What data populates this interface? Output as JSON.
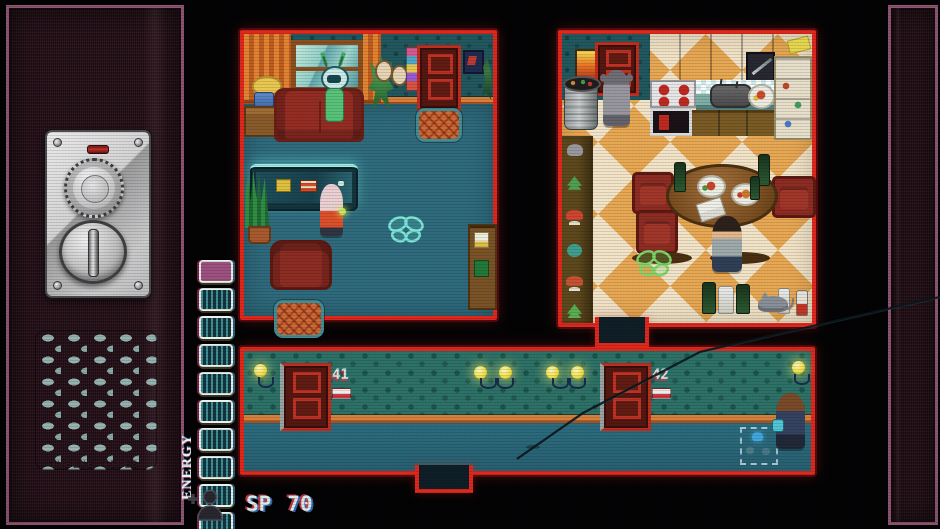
{
  "console": {
    "brand_label": "TWELVE TILES",
    "panel_color": "#281119",
    "trim_color": "#8d5472",
    "indicator_light_color": "#c23028",
    "controls": [
      "tuning-dial",
      "selector-knob"
    ]
  },
  "hud": {
    "energy_label": "ENERGY",
    "energy_segments_total": 10,
    "energy_segments_filled": 1,
    "energy_filled_color": "#9c517e",
    "energy_empty_stripe_color": "#3f8f96",
    "sp_label": "SP",
    "sp_value": "70",
    "follower_icon": "person-plus-icon"
  },
  "rooms": {
    "living_room": {
      "name": "living room",
      "objects": [
        "curtains",
        "window",
        "table-lamp",
        "side-table",
        "plant-vase",
        "couch",
        "alien-npc",
        "potted-plant",
        "wall-portraits",
        "wall-shelf",
        "door",
        "picture-frame",
        "door-mat",
        "tv-cabinet",
        "snake-plant",
        "girl-npc",
        "armchair",
        "floor-rug",
        "butterfly-marker",
        "bookshelf"
      ]
    },
    "kitchen": {
      "name": "kitchen",
      "objects": [
        "fire-picture",
        "door",
        "grey-npc",
        "trash-can",
        "upper-cabinets",
        "cutting-board",
        "stove",
        "backsplash",
        "sink-pot",
        "food-plate",
        "oven",
        "lower-cabinets",
        "fridge-shelf",
        "cheese-box",
        "shelf-rack",
        "dining-table",
        "plates",
        "bottles",
        "chairs",
        "man-npc",
        "envelope",
        "butterfly-marker",
        "floor-bottles",
        "grey-cat"
      ]
    },
    "hallway": {
      "name": "hallway",
      "door_left_number": "41",
      "door_right_number": "42",
      "objects": [
        "wall-lamps",
        "door-41",
        "door-42",
        "player-character",
        "dig-marker"
      ]
    }
  },
  "icons": {
    "follower": "person-plus-icon",
    "butterfly_living_color": "#7de8d8",
    "butterfly_kitchen_color": "#7fd86a"
  },
  "colors": {
    "room_border": "#e2261a",
    "living_floor": "#2d6b7d",
    "hall_floor": "#29687a",
    "kitchen_floor_light": "#f5e6c8",
    "kitchen_floor_accent": "#eaa952"
  }
}
